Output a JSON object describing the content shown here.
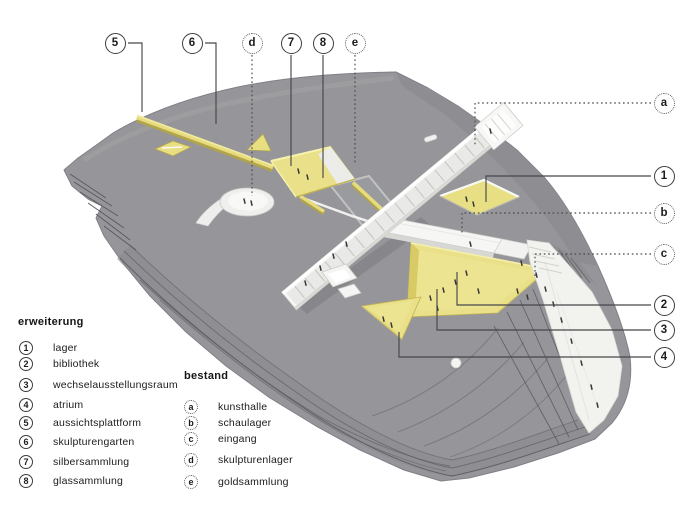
{
  "callouts": [
    {
      "id": "5",
      "type": "extension"
    },
    {
      "id": "6",
      "type": "extension"
    },
    {
      "id": "d",
      "type": "existing"
    },
    {
      "id": "7",
      "type": "extension"
    },
    {
      "id": "8",
      "type": "extension"
    },
    {
      "id": "e",
      "type": "existing"
    },
    {
      "id": "a",
      "type": "existing"
    },
    {
      "id": "1",
      "type": "extension"
    },
    {
      "id": "b",
      "type": "existing"
    },
    {
      "id": "c",
      "type": "existing"
    },
    {
      "id": "2",
      "type": "extension"
    },
    {
      "id": "3",
      "type": "extension"
    },
    {
      "id": "4",
      "type": "extension"
    }
  ],
  "legend_left": {
    "heading": "erweiterung",
    "items": [
      {
        "key": "1",
        "label": "lager"
      },
      {
        "key": "2",
        "label": "bibliothek"
      },
      {
        "key": "3",
        "label": "wechselausstellungsraum"
      },
      {
        "key": "4",
        "label": "atrium"
      },
      {
        "key": "5",
        "label": "aussichtsplattform"
      },
      {
        "key": "6",
        "label": "skulpturengarten"
      },
      {
        "key": "7",
        "label": "silbersammlung"
      },
      {
        "key": "8",
        "label": "glassammlung"
      }
    ]
  },
  "legend_right": {
    "heading": "bestand",
    "items": [
      {
        "key": "a",
        "label": "kunsthalle"
      },
      {
        "key": "b",
        "label": "schaulager"
      },
      {
        "key": "c",
        "label": "eingang"
      },
      {
        "key": "d",
        "label": "skulpturenlager"
      },
      {
        "key": "e",
        "label": "goldsammlung"
      }
    ]
  },
  "colors": {
    "terrain": "#96969a",
    "extension_yellow": "#e9e089",
    "existing_white": "#f5f5f3",
    "contour": "#5e5e63",
    "callout_line": "#47474b"
  }
}
